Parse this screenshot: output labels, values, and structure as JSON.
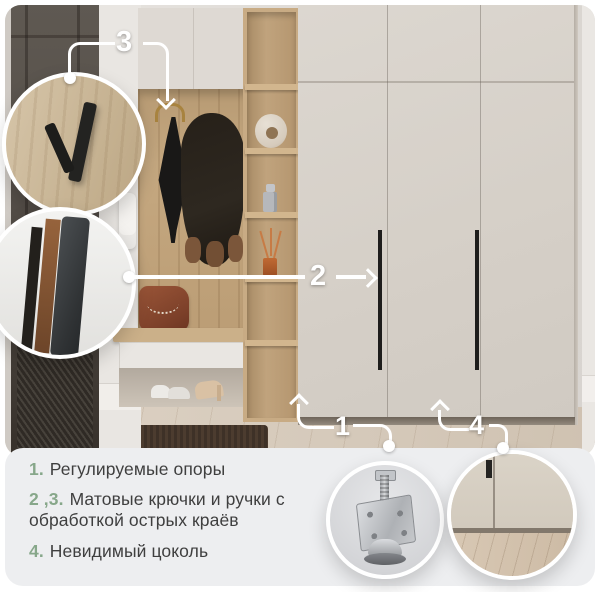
{
  "palette": {
    "accent_green": "#87a78a",
    "text_dark": "#3f3f3f",
    "panel_bg": "#edeef0",
    "callout_white": "#ffffff",
    "wardrobe_beige": "#d6d0c8",
    "oak_wood": "#c5a880",
    "door_dark": "#4e4841"
  },
  "callouts": {
    "c1": {
      "label": "1"
    },
    "c2": {
      "label": "2"
    },
    "c3": {
      "label": "3"
    },
    "c4": {
      "label": "4"
    }
  },
  "features": [
    {
      "num": "1.",
      "text": "Регулируемые опоры"
    },
    {
      "num": "2 ,3.",
      "text": "Матовые крючки и ручки с обработкой острых краёв"
    },
    {
      "num": "4.",
      "text": "Невидимый цоколь"
    }
  ]
}
